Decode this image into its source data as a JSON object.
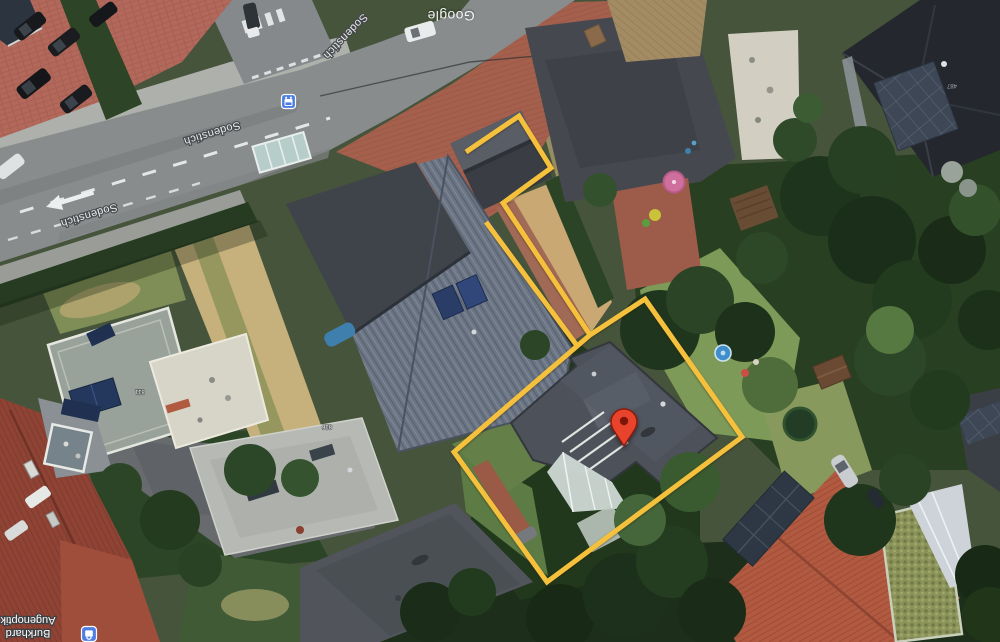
{
  "watermark": {
    "text": "Google"
  },
  "streets": {
    "label1": "Sodenstich",
    "label2": "Sodenstich",
    "label3": "Sodenstich"
  },
  "poi": {
    "line1": "Burkhard",
    "line2": "Augenoptik",
    "icon": "shopping-poi-icon",
    "icon_color": "#4f7ee3"
  },
  "transit": {
    "icon": "bus-stop-icon",
    "color": "#4a7de2"
  },
  "house_numbers": {
    "n1": "811",
    "n2": "816",
    "n3": "487"
  },
  "marker": {
    "name": "red-map-pin",
    "color": "#E8442B"
  },
  "boundary": {
    "name": "property-outline",
    "color": "#F5C13D"
  }
}
